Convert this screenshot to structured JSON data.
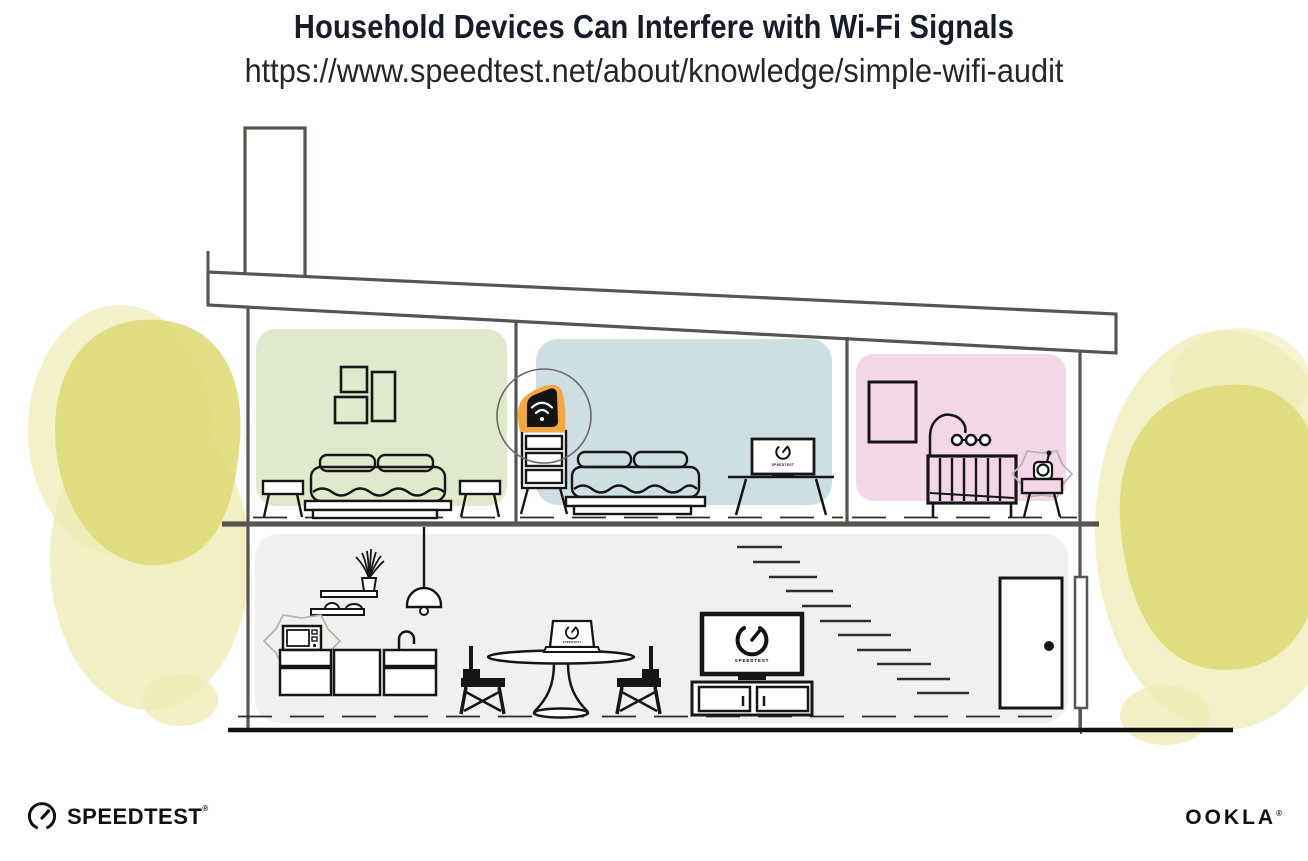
{
  "header": {
    "title": "Household Devices Can Interfere with Wi-Fi Signals",
    "url": "https://www.speedtest.net/about/knowledge/simple-wifi-audit"
  },
  "screens": {
    "bedroom_tv_label": "SPEEDTEST",
    "laptop_label": "SPEEDTEST",
    "living_tv_label": "SPEEDTEST"
  },
  "footer": {
    "speedtest_label": "SPEEDTEST",
    "speedtest_reg": "®",
    "ookla_label": "OOKLA",
    "ookla_reg": "®"
  },
  "icons": {
    "wifi_icon": "wi-fi signal arcs with dot",
    "gauge_icon": "speedtest speedometer dial with needle",
    "interference_icon": "jagged burst outline around interfering device"
  },
  "colors": {
    "title_text": "#181c2a",
    "url_text": "#26272c",
    "wall_green": "#dfeacc",
    "wall_blue": "#cddfe2",
    "wall_pink": "#f4d7e7",
    "ground_floor": "#f1f0ee",
    "router_orange": "#f2a742",
    "router_body": "#141414",
    "tree_yellow": "#dfdb7a",
    "tree_yellow_light": "#eeebb4",
    "structure_line": "#57554f",
    "furniture_line": "#161616"
  }
}
